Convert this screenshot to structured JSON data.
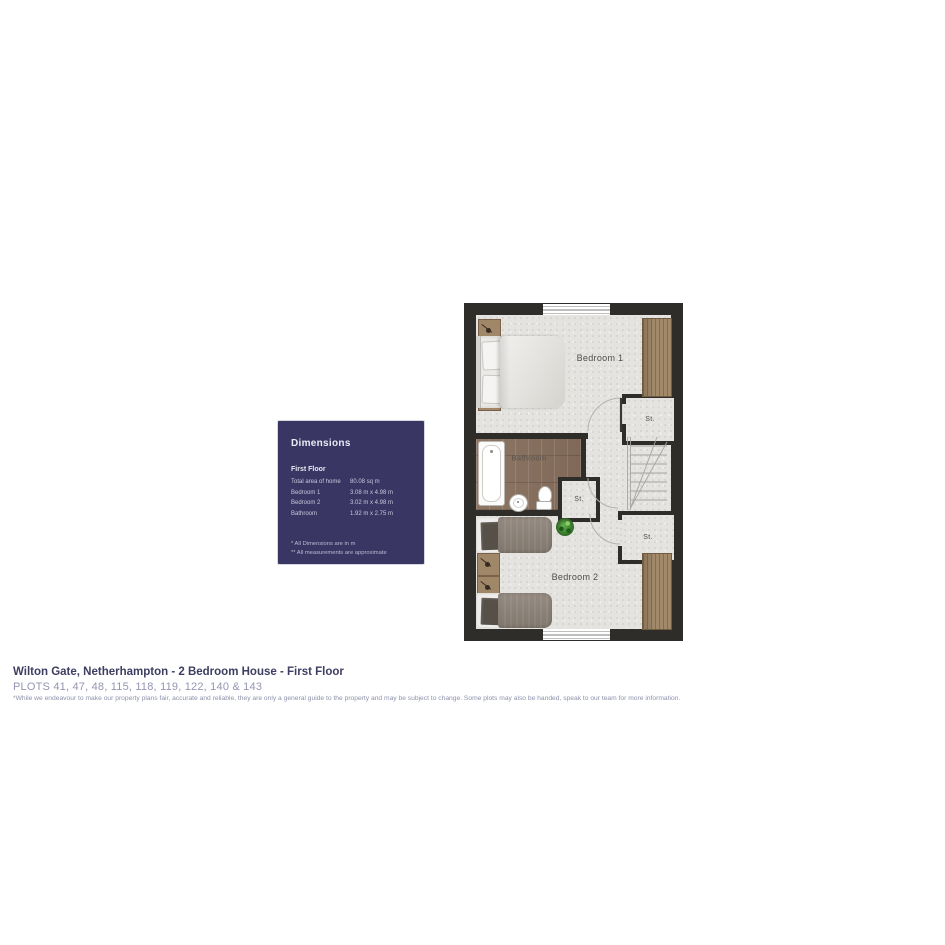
{
  "dimensions_panel": {
    "title": "Dimensions",
    "section": "First Floor",
    "rows": [
      {
        "label": "Total area of home",
        "value": "80.08 sq m"
      },
      {
        "label": "Bedroom 1",
        "value": "3.08 m x 4.98 m"
      },
      {
        "label": "Bedroom 2",
        "value": "3.02 m x 4.98 m"
      },
      {
        "label": "Bathroom",
        "value": "1.92 m x 2.75 m"
      }
    ],
    "footnotes": [
      "* All Dimensions are in m",
      "** All measurements are approximate"
    ]
  },
  "floorplan": {
    "labels": {
      "bedroom1": "Bedroom 1",
      "bathroom": "Bathroom",
      "bedroom2": "Bedroom 2",
      "storage": "St."
    }
  },
  "footer": {
    "title": "Wilton Gate, Netherhampton - 2 Bedroom House - First Floor",
    "plots": "PLOTS 41, 47, 48, 115, 118, 119, 122, 140 & 143",
    "disclaimer": "*While we endeavour to make our property plans fair, accurate and reliable, they are only a general guide to the property and may be subject to change. Some plots may also be handed, speak to our team for more information."
  },
  "colors": {
    "panel_bg": "#393663",
    "wall": "#2f2d2a",
    "carpet": "#e4e3e0",
    "wood_floor": "#8a7161",
    "wardrobe_wood": "#a2896a",
    "title_text": "#3e3d62",
    "plots_text": "#9396b2",
    "room_label_text": "#4e4e4c"
  }
}
